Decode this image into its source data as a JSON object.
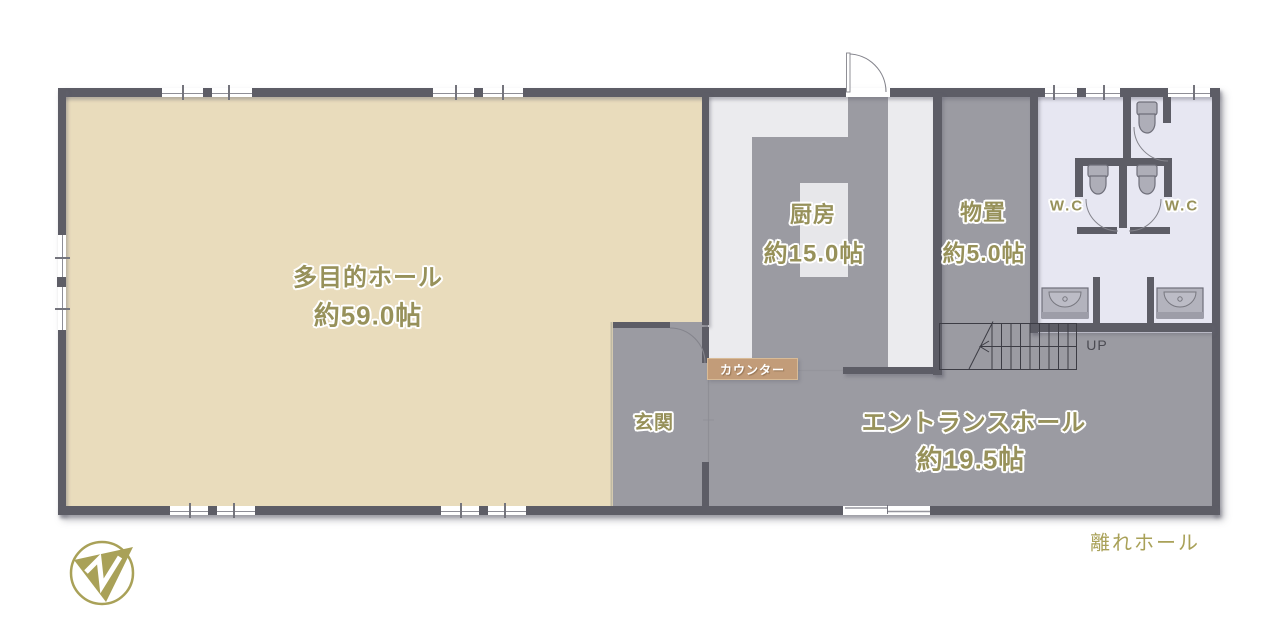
{
  "plan": {
    "title_caption": "離れホール",
    "rooms": {
      "hall": {
        "name": "多目的ホール",
        "size": "約59.0帖"
      },
      "kitchen": {
        "name": "厨房",
        "size": "約15.0帖"
      },
      "storage": {
        "name": "物置",
        "size": "約5.0帖"
      },
      "wc_left": {
        "name": "W.C"
      },
      "wc_right": {
        "name": "W.C"
      },
      "genkan": {
        "name": "玄関"
      },
      "entrance_hall": {
        "name": "エントランスホール",
        "size": "約19.5帖"
      }
    },
    "labels": {
      "counter": "カウンター",
      "stairs_up": "UP"
    },
    "icons": {
      "toilet": "toilet-icon",
      "washbasin": "sink-icon",
      "staircase": "staircase-icon",
      "door_swing": "door-swing-arc-icon",
      "sliding_door": "sliding-door-icon",
      "window": "window-icon",
      "logo": "company-logo"
    },
    "colors": {
      "wall": "#5d5d66",
      "hall_floor": "#e9dcbc",
      "gray_floor": "#9b9ba2",
      "kitchen_floor": "#ebebee",
      "wc_floor": "#e7e7f2",
      "counter": "#c29c79",
      "accent_text": "#97915a",
      "logo_gold": "#a9a158"
    }
  }
}
